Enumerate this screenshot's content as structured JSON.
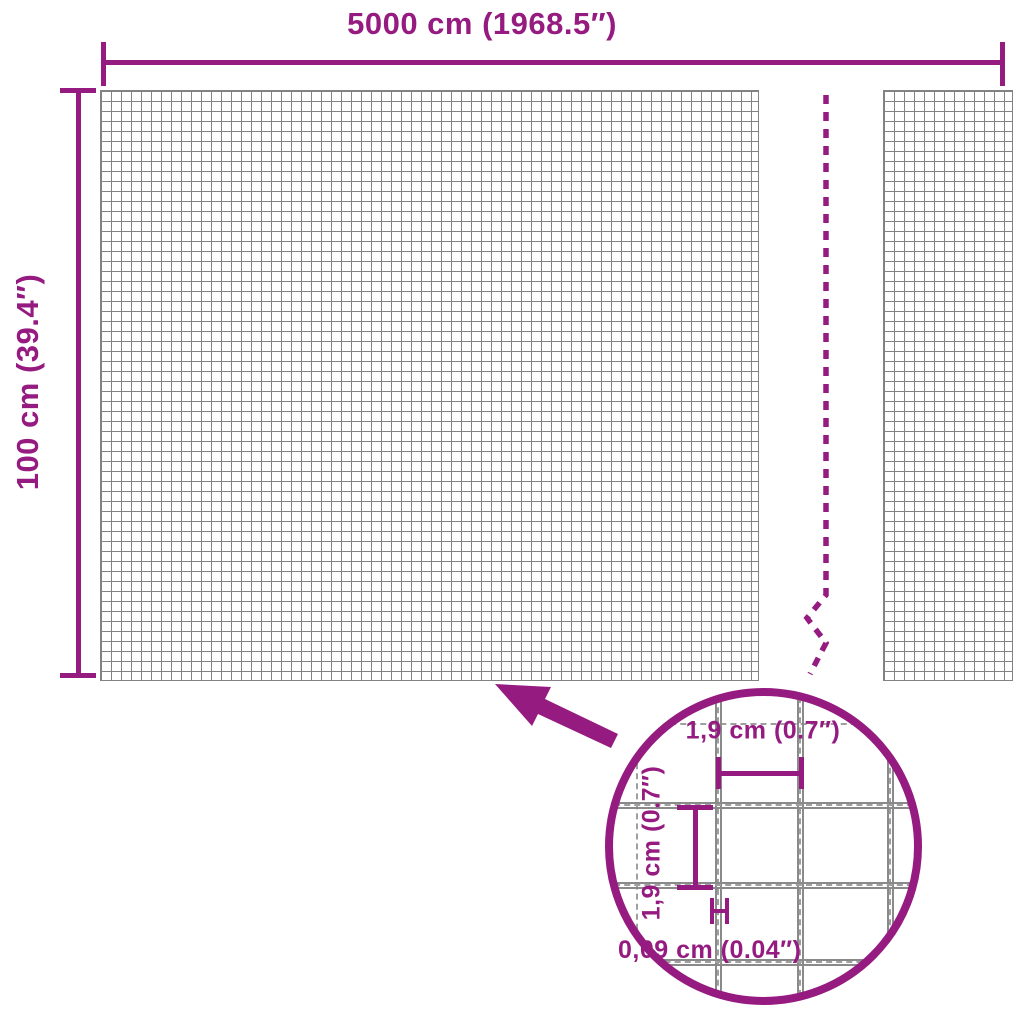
{
  "colors": {
    "accent": "#951b81",
    "mesh_line": "#828282",
    "wire_line": "#8a8a8a"
  },
  "dimensions": {
    "width_label": "5000 cm (1968.5″)",
    "height_label": "100 cm (39.4″)"
  },
  "detail": {
    "mesh_width_label": "1,9 cm (0.7″)",
    "mesh_height_label": "1,9 cm (0.7″)",
    "wire_thickness_label": "0,09 cm (0.04″)"
  }
}
